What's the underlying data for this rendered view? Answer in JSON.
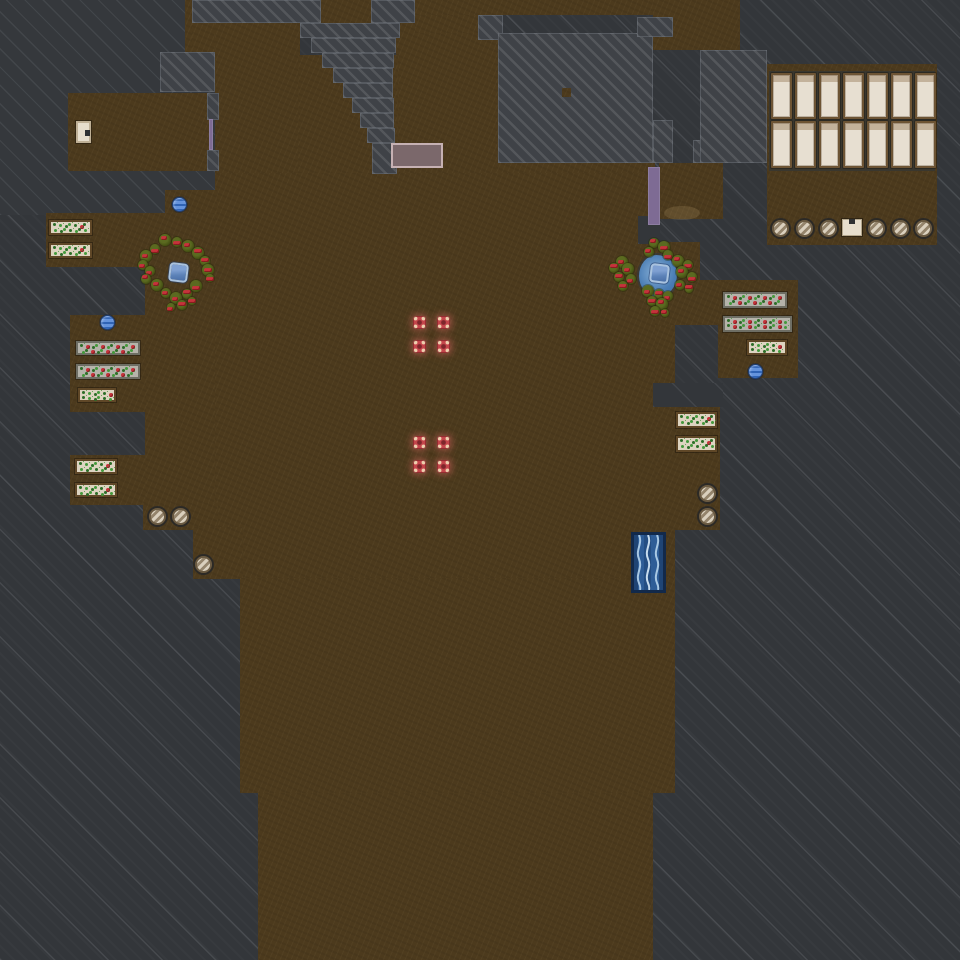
{
  "palette": {
    "rock": "#33363a",
    "rock_med": "#35383c",
    "rock_light": "#43464b",
    "dirt": "#4c3a1d",
    "wall": "#3a372e",
    "bed_frame": "#6d5434",
    "bed_fill": "#e7dfd1",
    "bed_pillow": "#c3b29b",
    "planter_beige": "#ddd4c1",
    "planter_gray": "#b5b3aa",
    "frame_brown": "#5f4727",
    "frame_gray": "#6e6e64",
    "sprout": "#44993c",
    "sprout_dark": "#2c6d28",
    "berry": "#c5333b",
    "bush_dark": "#3e490f",
    "bush_light": "#5b6a20",
    "marker": "#c4454b",
    "marker_core": "#7e262b",
    "marker_dot": "#eecfae",
    "marker_glow": "rgba(214,100,96,0.5)",
    "purple": "#7e6b94",
    "mauve": "#7b686b",
    "mauve_border": "#c6b1b3",
    "cream": "#e7decd",
    "stool_light": "#d9cfbd",
    "stool_dark": "#94846c",
    "stool_ring": "#6a5a42",
    "water": "#4a7db5",
    "water_deep": "#3a6aa3",
    "orb": "#6493dc",
    "orb_stripe": "#2f63b5",
    "orb_dark": "#1f4078",
    "bcrate": "#5c82b8",
    "bcrate_border": "#a9c2de"
  },
  "terrain": {
    "medium_rock": [
      [
        0,
        0,
        215,
        215
      ]
    ],
    "dirt": [
      [
        68,
        93,
        143,
        78
      ],
      [
        185,
        0,
        7,
        52
      ],
      [
        192,
        23,
        23,
        30
      ],
      [
        215,
        23,
        85,
        150
      ],
      [
        396,
        23,
        102,
        150
      ],
      [
        298,
        55,
        100,
        118
      ],
      [
        321,
        0,
        50,
        23
      ],
      [
        415,
        0,
        238,
        15
      ],
      [
        415,
        15,
        63,
        18
      ],
      [
        496,
        160,
        159,
        15
      ],
      [
        215,
        173,
        440,
        405
      ],
      [
        655,
        300,
        20,
        278
      ],
      [
        165,
        190,
        52,
        25
      ],
      [
        46,
        213,
        169,
        54
      ],
      [
        145,
        267,
        70,
        245
      ],
      [
        70,
        315,
        76,
        97
      ],
      [
        70,
        455,
        76,
        50
      ],
      [
        143,
        503,
        75,
        27
      ],
      [
        193,
        527,
        50,
        52
      ],
      [
        240,
        578,
        435,
        215
      ],
      [
        258,
        793,
        395,
        167
      ],
      [
        653,
        0,
        87,
        50
      ],
      [
        659,
        163,
        64,
        56
      ],
      [
        767,
        64,
        170,
        181
      ],
      [
        655,
        242,
        45,
        80
      ],
      [
        655,
        280,
        143,
        45
      ],
      [
        718,
        282,
        80,
        96
      ],
      [
        660,
        405,
        60,
        125
      ]
    ],
    "rock_patches": [
      [
        638,
        216,
        22,
        28
      ],
      [
        653,
        383,
        70,
        24
      ]
    ],
    "smooth_rock": [
      [
        192,
        0,
        129,
        23
      ],
      [
        371,
        0,
        44,
        23
      ],
      [
        300,
        23,
        100,
        15
      ],
      [
        311,
        38,
        85,
        15
      ],
      [
        322,
        53,
        72,
        15
      ],
      [
        333,
        68,
        60,
        15
      ],
      [
        343,
        83,
        50,
        15
      ],
      [
        352,
        98,
        42,
        15
      ],
      [
        360,
        113,
        34,
        15
      ],
      [
        367,
        128,
        28,
        15
      ],
      [
        372,
        143,
        25,
        31
      ],
      [
        478,
        15,
        25,
        25
      ],
      [
        498,
        33,
        155,
        130
      ],
      [
        637,
        17,
        36,
        20
      ],
      [
        653,
        120,
        20,
        43
      ],
      [
        693,
        140,
        47,
        23
      ],
      [
        160,
        52,
        55,
        40
      ],
      [
        207,
        93,
        12,
        27
      ],
      [
        207,
        150,
        12,
        21
      ],
      [
        700,
        50,
        67,
        113
      ]
    ],
    "dirt_dots": [
      [
        562,
        88,
        9,
        9
      ]
    ]
  },
  "objects": {
    "bedrooms": {
      "wall": [
        769,
        71,
        166,
        100
      ],
      "bed_xs": [
        771,
        795,
        819,
        843,
        867,
        891,
        915
      ],
      "bed_w": 21,
      "rows": [
        {
          "y": 73,
          "h": 46
        },
        {
          "y": 121,
          "h": 47
        }
      ]
    },
    "planters": [
      {
        "x": 49,
        "y": 220,
        "w": 43,
        "h": 15,
        "style": "beige"
      },
      {
        "x": 49,
        "y": 243,
        "w": 43,
        "h": 15,
        "style": "beige"
      },
      {
        "x": 76,
        "y": 341,
        "w": 64,
        "h": 14,
        "style": "gray"
      },
      {
        "x": 76,
        "y": 364,
        "w": 64,
        "h": 15,
        "style": "gray"
      },
      {
        "x": 78,
        "y": 388,
        "w": 38,
        "h": 14,
        "style": "beige"
      },
      {
        "x": 75,
        "y": 459,
        "w": 42,
        "h": 15,
        "style": "beige"
      },
      {
        "x": 75,
        "y": 483,
        "w": 42,
        "h": 14,
        "style": "beige"
      },
      {
        "x": 723,
        "y": 292,
        "w": 64,
        "h": 16,
        "style": "gray"
      },
      {
        "x": 723,
        "y": 316,
        "w": 69,
        "h": 16,
        "style": "gray"
      },
      {
        "x": 747,
        "y": 340,
        "w": 40,
        "h": 15,
        "style": "beige"
      },
      {
        "x": 676,
        "y": 412,
        "w": 41,
        "h": 16,
        "style": "beige"
      },
      {
        "x": 676,
        "y": 436,
        "w": 41,
        "h": 16,
        "style": "beige"
      }
    ],
    "stools": [
      [
        772,
        220
      ],
      [
        796,
        220
      ],
      [
        820,
        220
      ],
      [
        868,
        220
      ],
      [
        892,
        220
      ],
      [
        915,
        220
      ],
      [
        699,
        485
      ],
      [
        699,
        508
      ],
      [
        149,
        508
      ],
      [
        172,
        508
      ],
      [
        195,
        556
      ]
    ],
    "crates": [
      {
        "x": 842,
        "y": 219,
        "w": 20,
        "h": 17
      }
    ],
    "white_furniture": {
      "x": 76,
      "y": 121,
      "w": 15,
      "h": 22
    },
    "markers": [
      [
        413,
        316
      ],
      [
        437,
        316
      ],
      [
        413,
        340
      ],
      [
        437,
        340
      ],
      [
        413,
        436
      ],
      [
        437,
        436
      ],
      [
        413,
        460
      ],
      [
        437,
        460
      ]
    ],
    "blue_orbs": [
      [
        172,
        197
      ],
      [
        100,
        315
      ],
      [
        748,
        364
      ]
    ],
    "doors": [
      {
        "x": 209,
        "y": 119,
        "w": 4,
        "h": 31
      },
      {
        "x": 648,
        "y": 167,
        "w": 12,
        "h": 58
      }
    ],
    "table": {
      "x": 391,
      "y": 143,
      "w": 52,
      "h": 25
    },
    "waterfall": {
      "x": 631,
      "y": 532,
      "w": 35,
      "h": 61
    },
    "sand_patch": {
      "x": 664,
      "y": 206,
      "w": 36,
      "h": 14
    },
    "clusters": [
      {
        "side": "left",
        "pond": null,
        "item": {
          "x": 169,
          "y": 263
        },
        "bushes": [
          [
            165,
            240,
            6
          ],
          [
            177,
            242,
            5
          ],
          [
            188,
            246,
            6
          ],
          [
            155,
            249,
            5
          ],
          [
            146,
            256,
            6
          ],
          [
            198,
            253,
            6
          ],
          [
            143,
            265,
            5
          ],
          [
            205,
            261,
            5
          ],
          [
            150,
            271,
            5
          ],
          [
            208,
            270,
            6
          ],
          [
            146,
            279,
            5
          ],
          [
            210,
            278,
            4
          ],
          [
            157,
            285,
            6
          ],
          [
            196,
            286,
            6
          ],
          [
            166,
            293,
            5
          ],
          [
            187,
            294,
            5
          ],
          [
            176,
            298,
            6
          ],
          [
            182,
            305,
            5
          ],
          [
            171,
            307,
            4
          ],
          [
            192,
            301,
            4
          ]
        ]
      },
      {
        "side": "right",
        "pond": {
          "x": 639,
          "y": 255,
          "w": 38,
          "h": 42
        },
        "item": {
          "x": 650,
          "y": 264
        },
        "bushes": [
          [
            654,
            243,
            5
          ],
          [
            664,
            247,
            6
          ],
          [
            649,
            252,
            5
          ],
          [
            668,
            255,
            5
          ],
          [
            622,
            262,
            6
          ],
          [
            614,
            268,
            5
          ],
          [
            628,
            269,
            6
          ],
          [
            619,
            277,
            5
          ],
          [
            631,
            279,
            5
          ],
          [
            623,
            286,
            5
          ],
          [
            678,
            261,
            6
          ],
          [
            688,
            265,
            5
          ],
          [
            682,
            272,
            6
          ],
          [
            692,
            277,
            5
          ],
          [
            680,
            285,
            5
          ],
          [
            689,
            289,
            4
          ],
          [
            648,
            291,
            6
          ],
          [
            659,
            294,
            5
          ],
          [
            668,
            296,
            5
          ],
          [
            652,
            301,
            5
          ],
          [
            662,
            304,
            6
          ],
          [
            655,
            311,
            5
          ],
          [
            665,
            313,
            4
          ]
        ]
      }
    ]
  }
}
